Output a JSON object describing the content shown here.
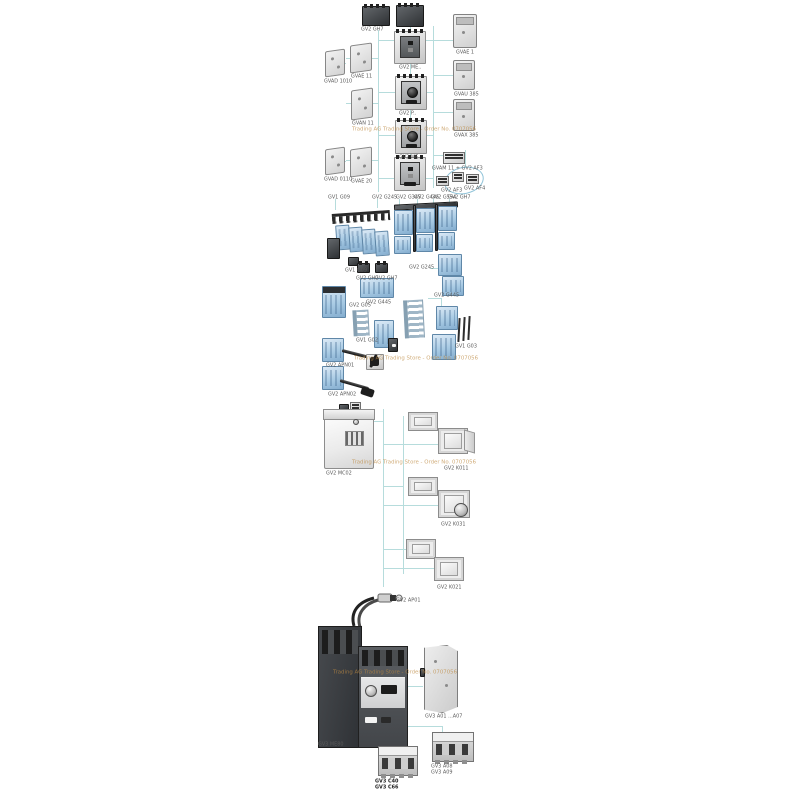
{
  "watermark": {
    "text": "Trading AG Trading Store - Order No. 0707056"
  },
  "colors": {
    "background": "#ffffff",
    "connector_line": "#b6dcdc",
    "label_text": "#5a5a5a",
    "watermark_text": "#bd8a42",
    "blue_component": "#a9cbe4",
    "dark_component": "#2e3134"
  },
  "labels": {
    "s1": [
      "GV2 GH7",
      "GV1 A01",
      "GV2 ME..",
      "GV2 P..",
      "GV2 ME..",
      "GVAD 1010",
      "GVAD 0110",
      "GVAE 11",
      "GVAN 11",
      "GVAE 20",
      "GVAE 1",
      "GVAU 385",
      "GVAX 385",
      "GVAM 11 + GV2 AF3",
      "GV2 AF3",
      "GV2 AF4",
      "GV1 G09",
      "GV2 G245",
      "GV2 G345",
      "GV2 G445",
      "GV2 G554",
      "GV2 GH7"
    ],
    "s2": [
      "GV1 G09",
      "GV2 GH7",
      "GV2 GH7",
      "GV2 G245",
      "GV2 G05",
      "GV2 G445"
    ],
    "s3": [
      "GV1 G02",
      "GV2 G445",
      "GV1 G03",
      "GV2 APN01",
      "GV2 APN02"
    ],
    "s4": [
      "GV2 MC02",
      "GV2 K011",
      "GV2 K031",
      "GV2 K021",
      "GV2 AP01"
    ],
    "s5": {
      "breaker": "GV3 ME80",
      "side_plate": "GV3 A01 ...A07",
      "block_left": [
        "GV3 C40",
        "GV3 C66"
      ],
      "block_right": [
        "GV3 A08",
        "GV3 A09"
      ]
    }
  }
}
